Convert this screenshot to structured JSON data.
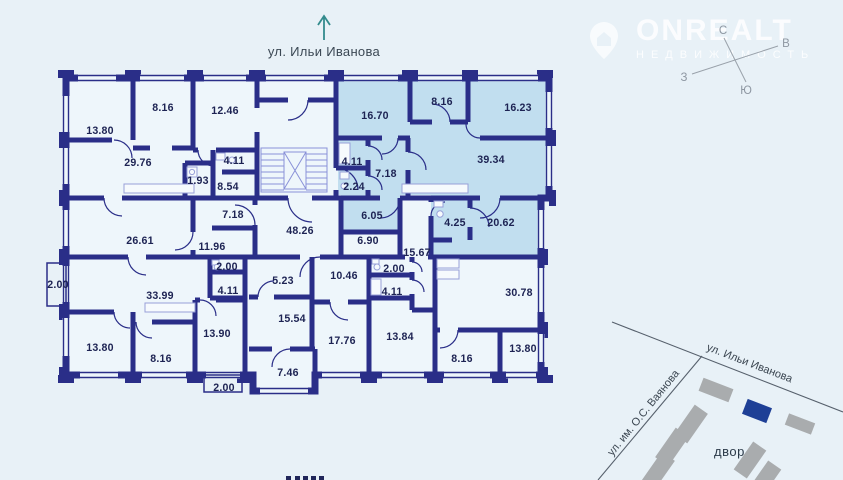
{
  "header": {
    "street": "ул. Ильи Иванова"
  },
  "watermark": {
    "brand": "ONREALT",
    "tagline": "НЕДВИЖИМОСТЬ"
  },
  "compass": {
    "n": "С",
    "e": "В",
    "w": "З",
    "s": "Ю"
  },
  "plan": {
    "rooms": [
      {
        "area": "13.80"
      },
      {
        "area": "8.16"
      },
      {
        "area": "12.46"
      },
      {
        "area": "29.76"
      },
      {
        "area": "4.11"
      },
      {
        "area": "1.93"
      },
      {
        "area": "8.54"
      },
      {
        "area": "7.18"
      },
      {
        "area": "26.61"
      },
      {
        "area": "11.96"
      },
      {
        "area": "2.00"
      },
      {
        "area": "33.99"
      },
      {
        "area": "2.00"
      },
      {
        "area": "4.11"
      },
      {
        "area": "48.26"
      },
      {
        "area": "6.90"
      },
      {
        "area": "15.67"
      },
      {
        "area": "5.23"
      },
      {
        "area": "10.46"
      },
      {
        "area": "2.00"
      },
      {
        "area": "4.11"
      },
      {
        "area": "13.80"
      },
      {
        "area": "8.16"
      },
      {
        "area": "13.90"
      },
      {
        "area": "2.00"
      },
      {
        "area": "15.54"
      },
      {
        "area": "7.46"
      },
      {
        "area": "17.76"
      },
      {
        "area": "13.84"
      },
      {
        "area": "8.16"
      },
      {
        "area": "13.80"
      },
      {
        "area": "30.78"
      },
      {
        "area": "16.70",
        "highlighted": true
      },
      {
        "area": "8.16",
        "highlighted": true
      },
      {
        "area": "16.23",
        "highlighted": true
      },
      {
        "area": "39.34",
        "highlighted": true
      },
      {
        "area": "4.11",
        "highlighted": true
      },
      {
        "area": "7.18",
        "highlighted": true
      },
      {
        "area": "2.24",
        "highlighted": true
      },
      {
        "area": "6.05",
        "highlighted": true
      },
      {
        "area": "4.25",
        "highlighted": true
      },
      {
        "area": "20.62",
        "highlighted": true
      }
    ]
  },
  "minimap": {
    "street_main": "ул. Ильи Иванова",
    "street_side": "ул. им. О.С. Ваянова",
    "courtyard": "двор"
  },
  "colors": {
    "bg": "#e8f1f7",
    "room": "#eef6fb",
    "highlight": "#c1deef",
    "wall": "#2a2e88",
    "label": "#1d2353",
    "accent_teal": "#338b8d",
    "map_building": "#a9acae",
    "map_selected": "#1e3f96"
  }
}
